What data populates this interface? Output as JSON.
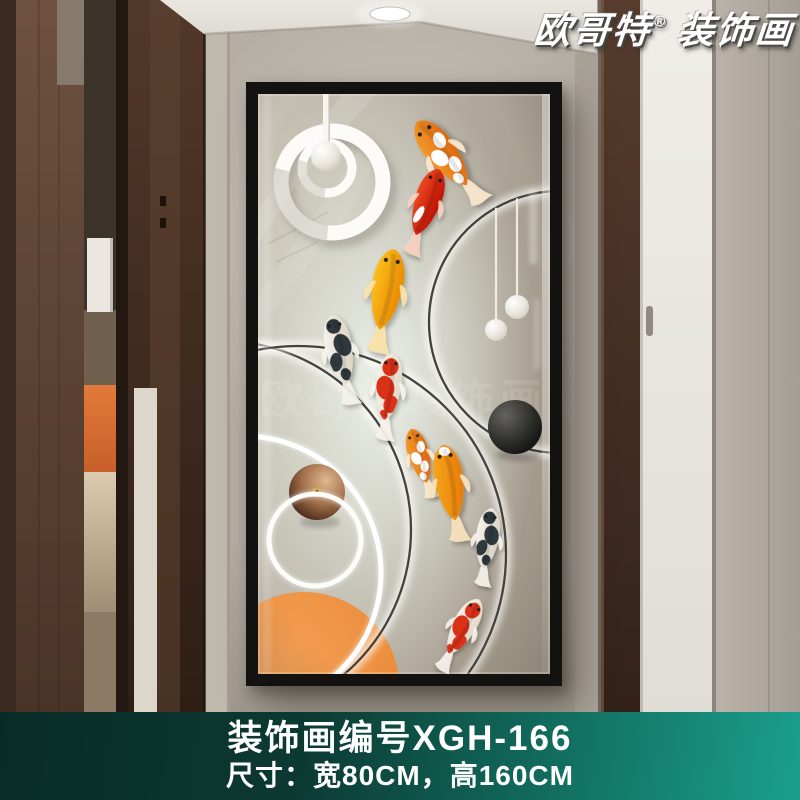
{
  "brand_badge": {
    "text": "欧哥特",
    "registered_mark": "®",
    "suffix": "装饰画"
  },
  "banner": {
    "model_line": "装饰画编号XGH-166",
    "size_line": "尺寸：宽80CM，高160CM",
    "text_color": "#ffffff",
    "bg_gradient": [
      "#092b26",
      "#0c3a33",
      "#127263",
      "#1b9f8e"
    ]
  },
  "scene": {
    "wall": "#b5aea4",
    "wood_edge": "#3a2a1f",
    "wood_panel_top": "#6e5140",
    "wood_panel_bottom": "#4a3427",
    "light_wedge": "#8a7f72",
    "recess_dark": "#3c332b",
    "recess_mid": "#70614f",
    "recess_box": "#ebe7e0",
    "recess_orange_hi": "#e27a3b",
    "recess_orange": "#c85f2b",
    "recess_light_top": "#dccbb0",
    "recess_light_bottom": "#9f8e75",
    "recess_floor": "#8c7a64",
    "slit": "#221711",
    "post_top": "#52382a",
    "post_bottom": "#2e1e14",
    "post_face": "#5f4331",
    "cream_sliver": "#dcd6cb",
    "pillar": "#bfb8ad",
    "edge_strip": "#a8a198",
    "door_frame_top": "#573c2d",
    "door_frame_bottom": "#33221a",
    "door_top": "#f0ede8",
    "door_bottom": "#e0ddd6",
    "door_handle": "#8f8981",
    "seam": "#8b857d",
    "right_wall": "#bab3aa",
    "right_wall_dark": "#a59e95",
    "ceiling": "#eae7e1",
    "ceiling_shadow": "#d8d4cc",
    "downlight": "#ffffff"
  },
  "artwork": {
    "frame_color": "#141210",
    "canvas_size": {
      "w": 292,
      "h": 580
    },
    "watermark": {
      "text": "欧哥特装饰画",
      "opacity": 0.1
    },
    "background": {
      "corner_tl": "#c8c2b4",
      "mid": "#b7b1a3",
      "corner_br": "#a49a8c",
      "glow": "#eef4ec"
    },
    "rings": [
      {
        "name": "right-halo-ring",
        "cx": 302,
        "cy": 228,
        "r": 131,
        "stroke": "#454239",
        "white_only": false
      },
      {
        "name": "lower-left-big-ring",
        "cx": 40,
        "cy": 460,
        "r": 208,
        "stroke": "#454239",
        "white_only": false
      },
      {
        "name": "orange-crossing-ring",
        "cx": -36,
        "cy": 436,
        "r": 189,
        "stroke": "#454239",
        "white_only": false
      },
      {
        "name": "white-glow-arc",
        "cx": -14,
        "cy": 479,
        "r": 137,
        "stroke": "#ffffff",
        "white_only": true
      },
      {
        "name": "small-white-ring",
        "cx": 57,
        "cy": 446,
        "r": 46,
        "stroke": "#fcfcf9",
        "white_only": true
      }
    ],
    "orange_circle": {
      "cx": 46,
      "cy": 593,
      "r": 95,
      "color_hi": "#f5a055",
      "color": "#ea8c3a",
      "color_lo": "#dd7c2c"
    },
    "black_sphere": {
      "cx": 257,
      "cy": 333,
      "r": 27
    },
    "bronze_sphere": {
      "cx": 59,
      "cy": 398,
      "r": 28,
      "knob_color": "#c9a145",
      "knob_dark": "#3a2710"
    },
    "mobile": {
      "rod": {
        "x": 65,
        "w": 7,
        "h": 60
      },
      "ball": {
        "cx": 68,
        "cy": 62,
        "r": 15
      },
      "rings": [
        {
          "cx": 69,
          "cy": 74,
          "r": 25,
          "w": 9
        },
        {
          "cx": 74,
          "cy": 88,
          "r": 51,
          "w": 15
        }
      ]
    },
    "pendants": [
      {
        "x": 238,
        "ball_cy": 236,
        "ball_r": 11
      },
      {
        "x": 259,
        "ball_cy": 213,
        "ball_r": 12
      }
    ],
    "fish": [
      {
        "x": 187,
        "y": 63,
        "rot": -38,
        "len": 95,
        "palette": "orange_white"
      },
      {
        "x": 168,
        "y": 112,
        "rot": 19,
        "len": 82,
        "palette": "red"
      },
      {
        "x": 128,
        "y": 200,
        "rot": 10,
        "len": 96,
        "palette": "gold"
      },
      {
        "x": 82,
        "y": 260,
        "rot": -11,
        "len": 84,
        "palette": "white_black"
      },
      {
        "x": 130,
        "y": 297,
        "rot": 6,
        "len": 80,
        "palette": "red_white"
      },
      {
        "x": 162,
        "y": 365,
        "rot": -16,
        "len": 66,
        "palette": "orange_white"
      },
      {
        "x": 192,
        "y": 393,
        "rot": -9,
        "len": 90,
        "palette": "golden"
      },
      {
        "x": 229,
        "y": 448,
        "rot": 8,
        "len": 72,
        "palette": "white_black"
      },
      {
        "x": 204,
        "y": 536,
        "rot": 29,
        "len": 74,
        "palette": "red_white"
      }
    ],
    "palettes": {
      "orange_white": {
        "body": [
          "#f59d2e",
          "#df6a0f"
        ],
        "fin": "#fde9cf",
        "patch": "#ffffff",
        "eye": "#24211d",
        "patches": [
          [
            5,
            -14,
            5,
            7
          ],
          [
            -4,
            -2,
            6,
            8
          ],
          [
            3,
            10,
            5,
            7
          ],
          [
            -2,
            21,
            4,
            5
          ]
        ]
      },
      "red": {
        "body": [
          "#f04c24",
          "#bf1404"
        ],
        "fin": "#fad2c2",
        "patch": "#ffffff",
        "eye": "#231f1b",
        "patches": [
          [
            -4,
            10,
            3.5,
            9
          ]
        ]
      },
      "gold": {
        "body": [
          "#fcc41e",
          "#eb8c02"
        ],
        "fin": "#fbe3a8",
        "patch": null,
        "eye": "#2a2519",
        "patches": []
      },
      "golden": {
        "body": [
          "#f7a91f",
          "#e87d05"
        ],
        "fin": "#fbe3bd",
        "patch": "#ffffff",
        "eye": "#2a2318",
        "patches": [
          [
            0,
            -32,
            5,
            4
          ]
        ]
      },
      "white_black": {
        "body": [
          "#f7f4ed",
          "#dcd6c8"
        ],
        "fin": "#f6f3ea",
        "patch": "#2e383d",
        "eye": "#1d2428",
        "patches": [
          [
            -1,
            -27,
            7,
            7
          ],
          [
            4,
            -8,
            8,
            11
          ],
          [
            -5,
            7,
            6,
            9
          ],
          [
            2,
            20,
            5,
            6
          ]
        ]
      },
      "red_white": {
        "body": [
          "#f6f2e9",
          "#e3dccd"
        ],
        "fin": "#f8f4ec",
        "patch": "#d93018",
        "eye": "#33241c",
        "patches": [
          [
            0,
            -24,
            8,
            9
          ],
          [
            -3,
            -3,
            9,
            12
          ],
          [
            4,
            13,
            7,
            9
          ],
          [
            -2,
            24,
            4,
            5
          ]
        ]
      }
    }
  }
}
